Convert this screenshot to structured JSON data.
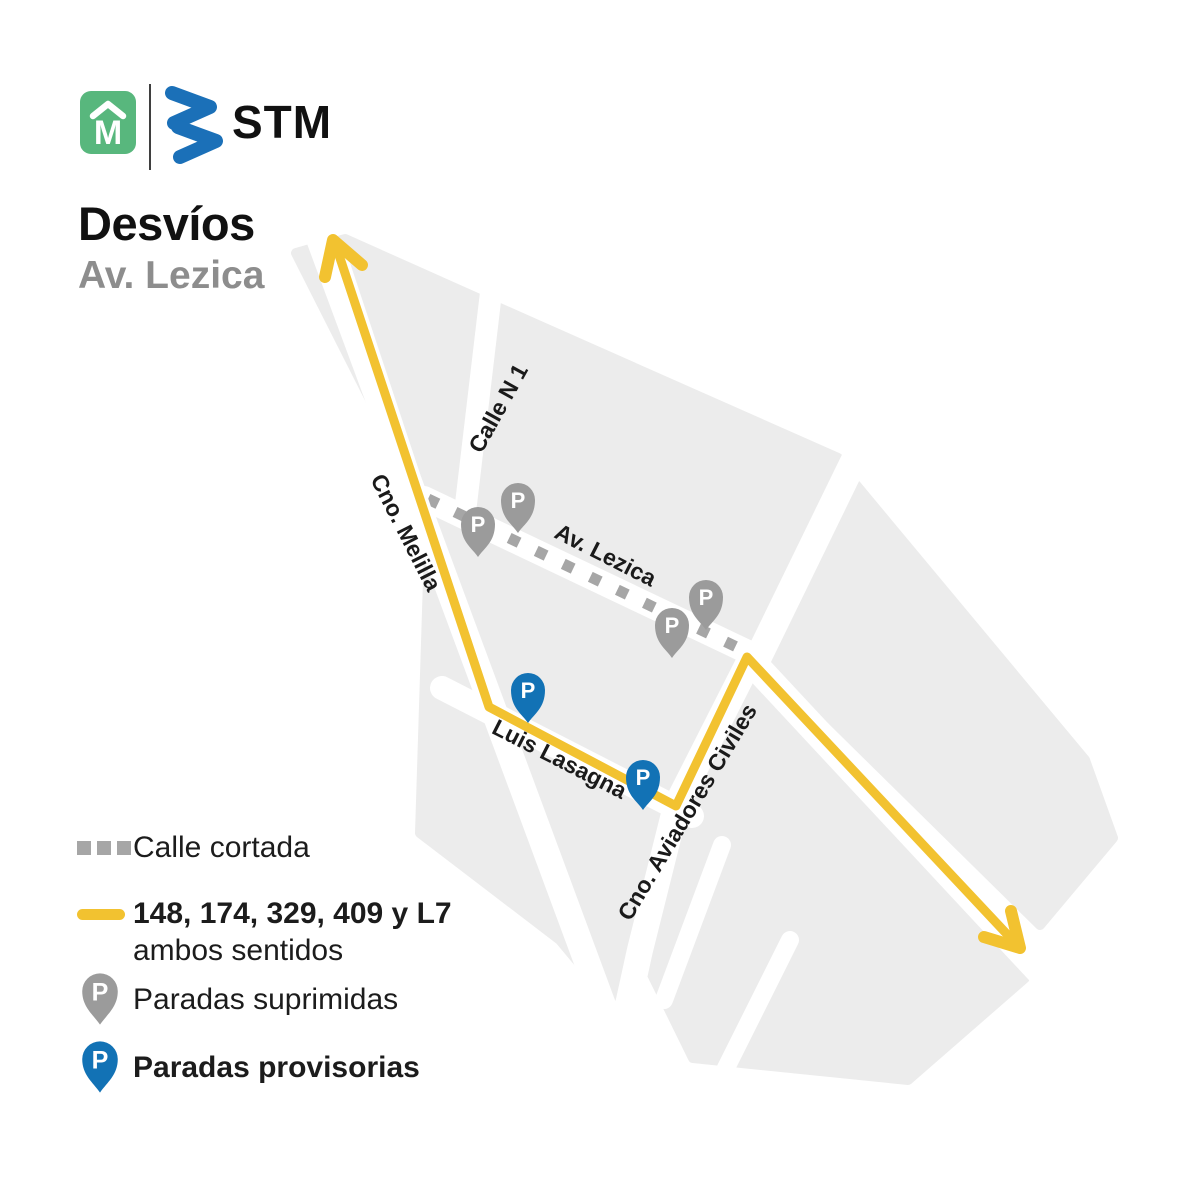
{
  "header": {
    "muni_logo_letter": "M",
    "brand": "STM",
    "title": "Desvíos",
    "subtitle": "Av. Lezica"
  },
  "map": {
    "pin_letter": "P",
    "streets": [
      {
        "name": "Calle N 1"
      },
      {
        "name": "Cno. Melilla"
      },
      {
        "name": "Av. Lezica"
      },
      {
        "name": "Luis Lasagna"
      },
      {
        "name": "Cno. Aviadores Civiles"
      }
    ]
  },
  "legend": {
    "closed_street": "Calle cortada",
    "routes": "148, 174, 329, 409 y L7",
    "routes_note": "ambos sentidos",
    "suppressed": "Paradas suprimidas",
    "provisional": "Paradas provisorias"
  },
  "colors": {
    "route_yellow": "#f2c230",
    "stop_suppressed_gray": "#9b9b9b",
    "stop_provisional_blue": "#1272b5",
    "block_gray": "#ececec",
    "dash_gray": "#a6a6a6",
    "muni_green": "#58b77d",
    "stm_blue": "#1b70b8",
    "subtitle_gray": "#8d8d8d",
    "text_black": "#111111"
  }
}
